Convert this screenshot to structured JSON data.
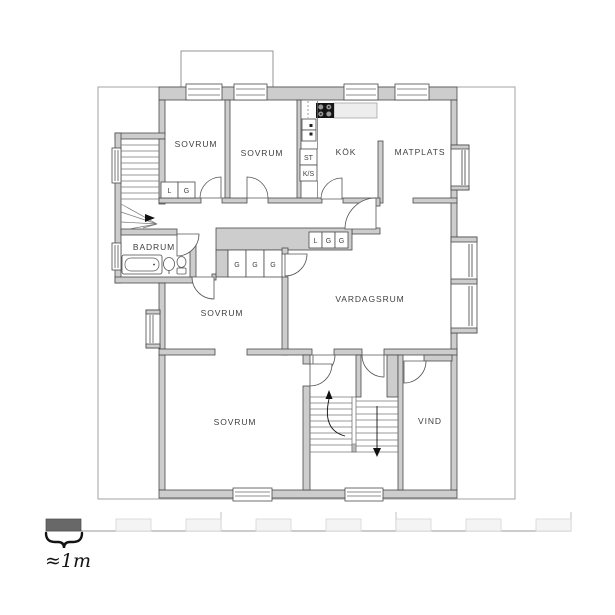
{
  "plan": {
    "rooms": {
      "sovrum_nw": {
        "label": "SOVRUM"
      },
      "sovrum_n": {
        "label": "SOVRUM"
      },
      "kok": {
        "label": "KÖK"
      },
      "matplats": {
        "label": "MATPLATS"
      },
      "badrum": {
        "label": "BADRUM"
      },
      "sovrum_mid": {
        "label": "SOVRUM"
      },
      "vardagsrum": {
        "label": "VARDAGSRUM"
      },
      "sovrum_s": {
        "label": "SOVRUM"
      },
      "vind": {
        "label": "VIND"
      }
    },
    "closets": {
      "nw_l": "L",
      "nw_g": "G",
      "st": "ST",
      "ks": "K/S",
      "hall_l": "L",
      "hall_g1": "G",
      "hall_g2": "G",
      "mid_g1": "G",
      "mid_g2": "G",
      "mid_g3": "G"
    },
    "colors": {
      "wall_fill": "#cdcdcd",
      "wall_stroke": "#4a4a4a",
      "boundary": "#a3a3a3",
      "counter": "#ededed",
      "stove": "#151515"
    }
  },
  "scale_bar": {
    "label": "≈1m",
    "dark_color": "#686868",
    "light_color": "#f4f4f4"
  }
}
